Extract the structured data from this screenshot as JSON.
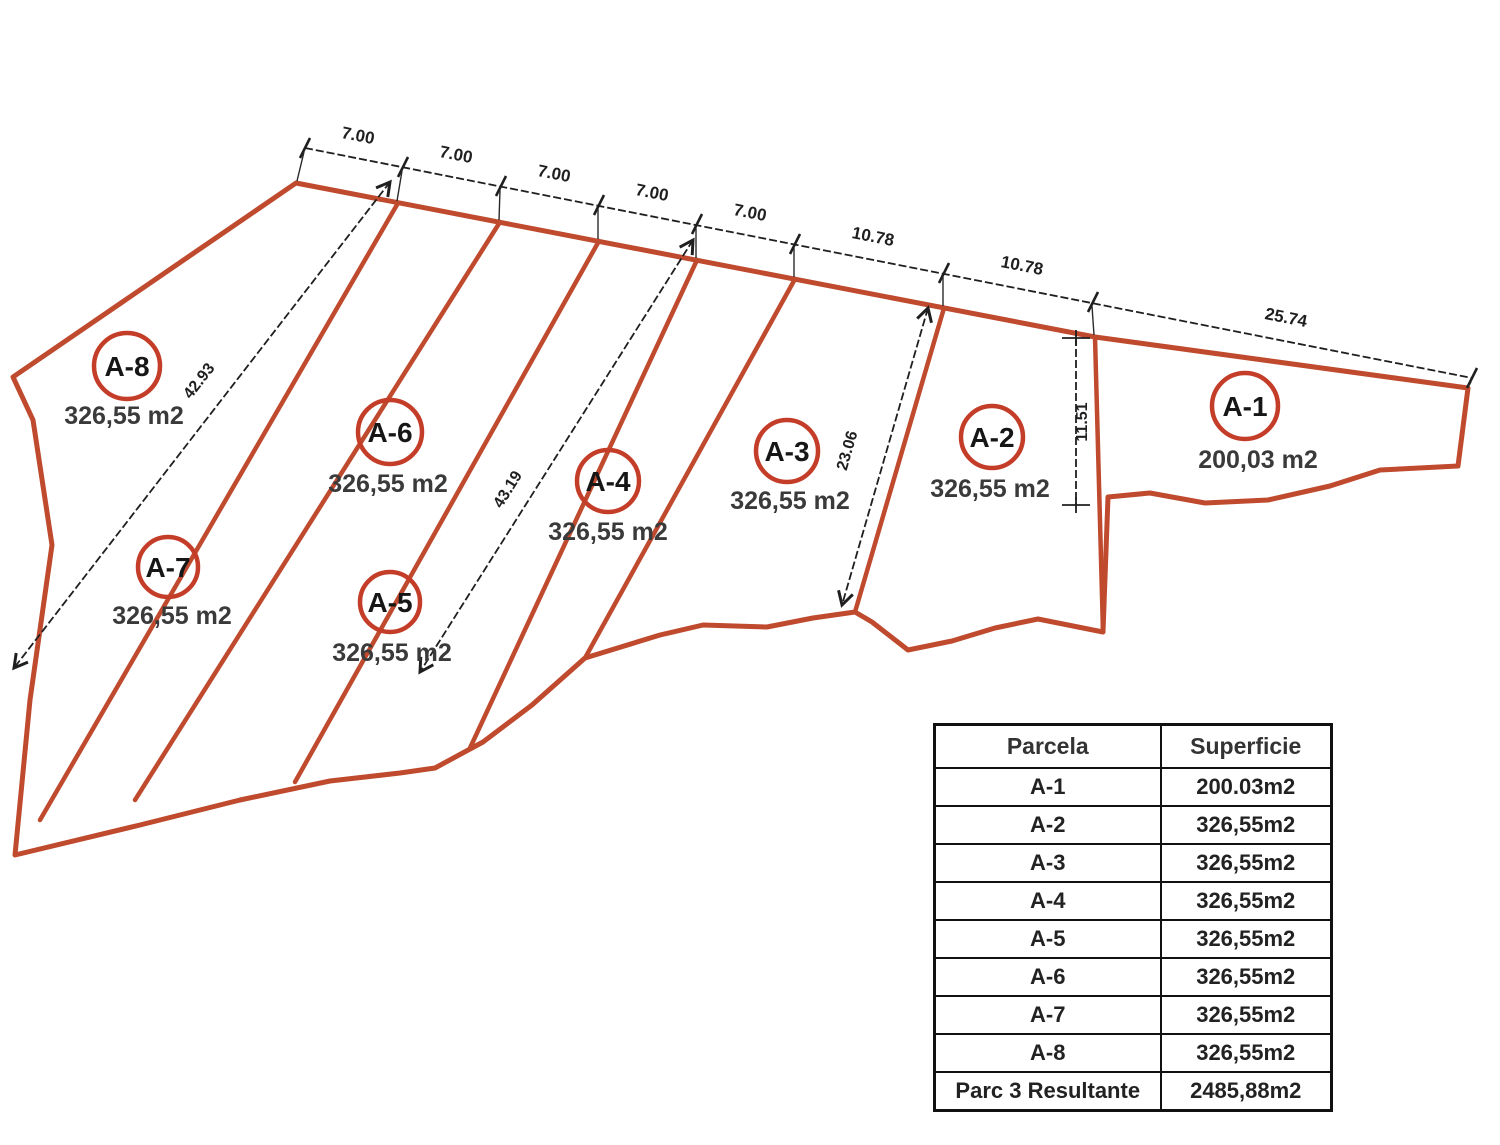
{
  "diagram": {
    "colors": {
      "parcel_line": "#bf4a2e",
      "circle": "#c43d28",
      "dimension": "#1f1f1f"
    },
    "top_dimensions": [
      {
        "label": "7.00",
        "x": 357,
        "y": 141,
        "rot": 11.1
      },
      {
        "label": "7.00",
        "x": 455,
        "y": 160,
        "rot": 11.1
      },
      {
        "label": "7.00",
        "x": 553,
        "y": 179,
        "rot": 11.1
      },
      {
        "label": "7.00",
        "x": 651,
        "y": 198,
        "rot": 11.1
      },
      {
        "label": "7.00",
        "x": 749,
        "y": 218,
        "rot": 11.1
      },
      {
        "label": "10.78",
        "x": 872,
        "y": 242,
        "rot": 11.1
      },
      {
        "label": "10.78",
        "x": 1021,
        "y": 271,
        "rot": 11.1
      },
      {
        "label": "25.74",
        "x": 1285,
        "y": 323,
        "rot": 11.1
      }
    ],
    "diagonal_dimensions": [
      {
        "label": "42.93",
        "x": 203,
        "y": 384,
        "rot": -52
      },
      {
        "label": "43.19",
        "x": 512,
        "y": 492,
        "rot": -58
      },
      {
        "label": "23.06",
        "x": 852,
        "y": 452,
        "rot": -74
      },
      {
        "label": "11.51",
        "x": 1087,
        "y": 422,
        "rot": -90
      }
    ],
    "parcels": [
      {
        "id": "A-1",
        "area": "200,03 m2",
        "cx": 1245,
        "cy": 406,
        "r": 33,
        "ax": 1258,
        "ay": 468
      },
      {
        "id": "A-2",
        "area": "326,55 m2",
        "cx": 992,
        "cy": 437,
        "r": 31,
        "ax": 990,
        "ay": 497
      },
      {
        "id": "A-3",
        "area": "326,55 m2",
        "cx": 787,
        "cy": 451,
        "r": 31,
        "ax": 790,
        "ay": 509
      },
      {
        "id": "A-4",
        "area": "326,55 m2",
        "cx": 608,
        "cy": 481,
        "r": 31,
        "ax": 608,
        "ay": 540
      },
      {
        "id": "A-5",
        "area": "326,55 m2",
        "cx": 390,
        "cy": 602,
        "r": 30,
        "ax": 392,
        "ay": 661
      },
      {
        "id": "A-6",
        "area": "326,55 m2",
        "cx": 390,
        "cy": 432,
        "r": 32,
        "ax": 388,
        "ay": 492
      },
      {
        "id": "A-7",
        "area": "326,55 m2",
        "cx": 168,
        "cy": 567,
        "r": 30,
        "ax": 172,
        "ay": 624
      },
      {
        "id": "A-8",
        "area": "326,55 m2",
        "cx": 127,
        "cy": 366,
        "r": 33,
        "ax": 124,
        "ay": 424
      }
    ]
  },
  "table": {
    "headers": [
      "Parcela",
      "Superficie"
    ],
    "rows": [
      {
        "parcela": "A-1",
        "superficie": "200.03m2"
      },
      {
        "parcela": "A-2",
        "superficie": "326,55m2"
      },
      {
        "parcela": "A-3",
        "superficie": "326,55m2"
      },
      {
        "parcela": "A-4",
        "superficie": "326,55m2"
      },
      {
        "parcela": "A-5",
        "superficie": "326,55m2"
      },
      {
        "parcela": "A-6",
        "superficie": "326,55m2"
      },
      {
        "parcela": "A-7",
        "superficie": "326,55m2"
      },
      {
        "parcela": "A-8",
        "superficie": "326,55m2"
      },
      {
        "parcela": "Parc 3 Resultante",
        "superficie": "2485,88m2"
      }
    ]
  }
}
